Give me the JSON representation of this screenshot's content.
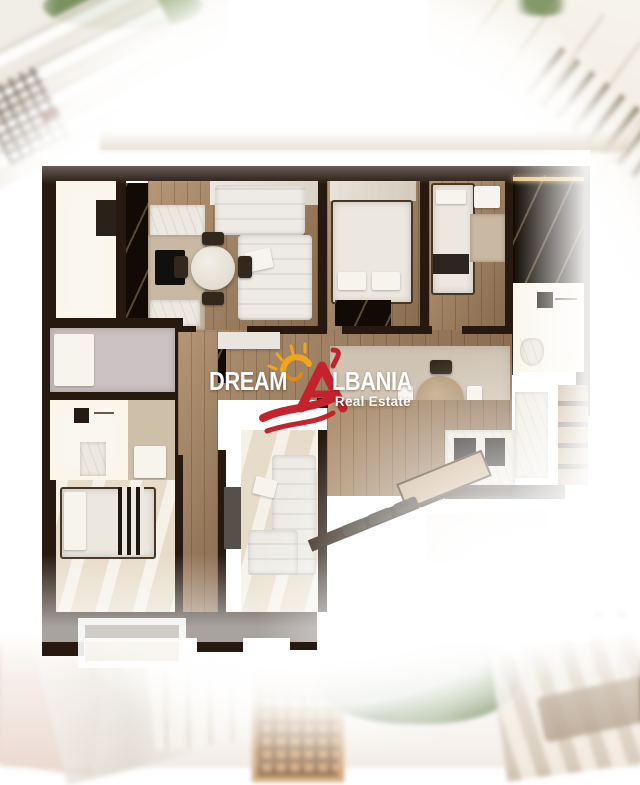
{
  "logo": {
    "word_left": "DREAM",
    "word_right": "LBANIA",
    "tagline": "Real Estate",
    "icons": {
      "sun": "sun-rays-icon",
      "house": "house-letter-a-icon",
      "swoosh": "double-swoosh-icon"
    },
    "colors": {
      "brand_red": "#c4232b",
      "sun_yellow": "#f2a41b",
      "text_white": "#ffffff"
    }
  },
  "scene_palette": {
    "wall_dark": "#271910",
    "wood_floor": "#9b7a5a",
    "floor_cream": "#e7dcc9",
    "rug_beige": "#cfc3b2",
    "white_room": "#faf7f1",
    "backdrop_white": "#ffffff"
  }
}
